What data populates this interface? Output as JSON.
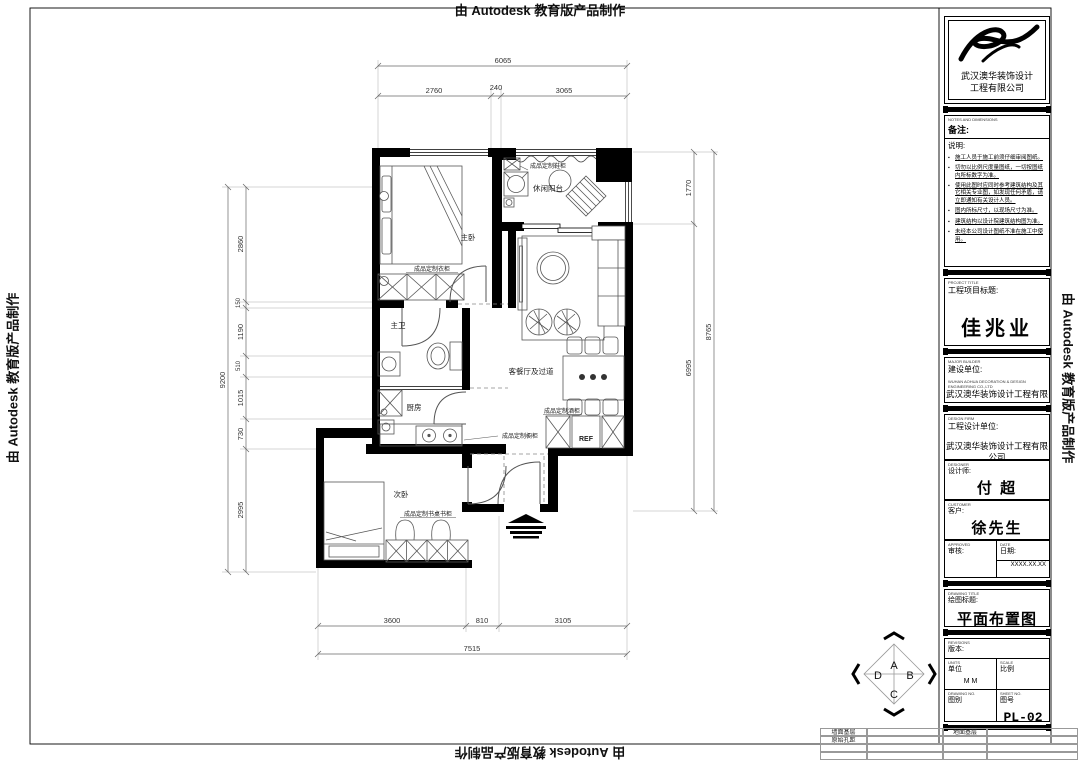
{
  "edge_banner": "由 Autodesk 教育版产品制作",
  "plan": {
    "rooms": {
      "master": "主卧",
      "balcony": "休闲阳台",
      "bath": "主卫",
      "kitchen": "厨房",
      "living": "客餐厅及过道",
      "bedroom2": "次卧",
      "fridge": "REF"
    },
    "cabinets": {
      "shoe": "成品定制鞋柜",
      "wardrobe": "成品定制衣柜",
      "kitchen_cab": "成品定制橱柜",
      "wine": "成品定制酒柜",
      "desk": "成品定制书桌书柜"
    }
  },
  "dims": {
    "top": {
      "overall": "6065",
      "segments": [
        "2760",
        "240",
        "3065"
      ]
    },
    "bottom": {
      "overall": "7515",
      "segments": [
        "3600",
        "810",
        "3105"
      ]
    },
    "left": {
      "overall": "9200",
      "segments": [
        "2860",
        "150",
        "1190",
        "510",
        "1015",
        "730",
        "2995"
      ]
    },
    "right": {
      "overall": "8765",
      "segments": [
        "1770",
        "6995"
      ]
    }
  },
  "ref_symbol": {
    "a": "A",
    "b": "B",
    "c": "C",
    "d": "D"
  },
  "titleblock": {
    "company_line1": "武汉澳华装饰设计",
    "company_line2": "工程有限公司",
    "notes_en": "NOTES AND DIMENSIONS",
    "notes_label": "备注:",
    "notes_sub": "说明:",
    "notes": [
      "施工人员于施工前须仔细审阅图纸。",
      "切勿以比例尺度量图纸，一切按图纸内所标数字为准。",
      "使用此图时应同时参考建筑结构及其它相关专业图，如发现任何矛盾，请立即通知有关设计人员。",
      "图内所标尺寸，以现场尺寸为准。",
      "建筑结构以设计院建筑结构图为准。",
      "未经本公司设计图纸不准在施工中使用。"
    ],
    "project_en": "PROJECT TITLE",
    "project_label": "工程项目标题:",
    "project_title": "佳兆业",
    "builder_en": "MAJOR BUILDER",
    "builder_label": "建设单位:",
    "builder_co_en": "WUHAN AOHUA DECORATION & DESIGN ENGINEERING CO.,LTD",
    "builder_co": "武汉澳华装饰设计工程有限公司",
    "firm_en": "DESIGN FIRM",
    "firm_label": "工程设计单位:",
    "firm_co": "武汉澳华装饰设计工程有限公司",
    "designer_en": "DESIGNER",
    "designer_label": "设计师:",
    "designer": "付 超",
    "customer_en": "CUSTOMER",
    "customer_label": "客户:",
    "customer": "徐先生",
    "approved_en": "APPROVED",
    "approved_label": "审核:",
    "date_en": "DATE",
    "date_label": "日期:",
    "date_value": "XXXX.XX.XX",
    "drawtitle_en": "DRAWING TITLE",
    "drawtitle_label": "绘图标题:",
    "drawing_title": "平面布置图",
    "revisions_en": "REVISIONS",
    "revisions_label": "版本:",
    "units_en": "UNITS",
    "units_label": "单位",
    "units_value": "M M",
    "scale_en": "SCALE",
    "scale_label": "比例",
    "dwgno_en": "DRAWING NO.",
    "dwgno_label": "图别",
    "sheetno_en": "SHEET NO.",
    "sheetno_label": "图号",
    "sheet_no": "PL-02"
  },
  "footer_table": {
    "wall_base": "墙面基层",
    "orig_holes": "原始孔距",
    "floor_base": "地面基层"
  }
}
